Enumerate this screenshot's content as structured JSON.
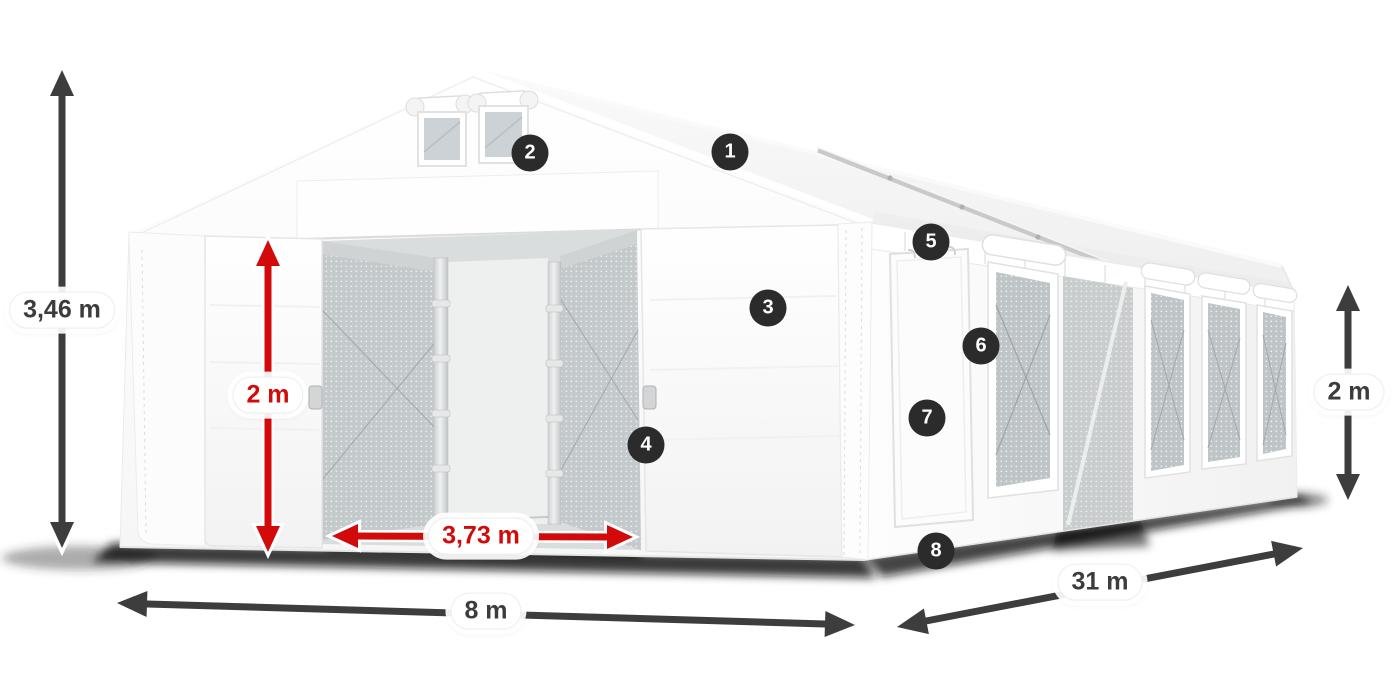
{
  "colors": {
    "accent_red": "#d20a0a",
    "arrow_dark": "#3d3d3d",
    "badge_bg": "#2b2b2b",
    "label_dark": "#3c3c3c"
  },
  "dimensions": [
    {
      "id": "total-height",
      "label": "3,46 m",
      "style": "dark"
    },
    {
      "id": "door-height",
      "label": "2 m",
      "style": "red"
    },
    {
      "id": "door-width",
      "label": "3,73 m",
      "style": "red"
    },
    {
      "id": "front-width",
      "label": "8 m",
      "style": "dark"
    },
    {
      "id": "length",
      "label": "31 m",
      "style": "dark"
    },
    {
      "id": "side-height",
      "label": "2 m",
      "style": "dark"
    }
  ],
  "callouts": [
    {
      "number": "1"
    },
    {
      "number": "2"
    },
    {
      "number": "3"
    },
    {
      "number": "4"
    },
    {
      "number": "5"
    },
    {
      "number": "6"
    },
    {
      "number": "7"
    },
    {
      "number": "8"
    }
  ]
}
